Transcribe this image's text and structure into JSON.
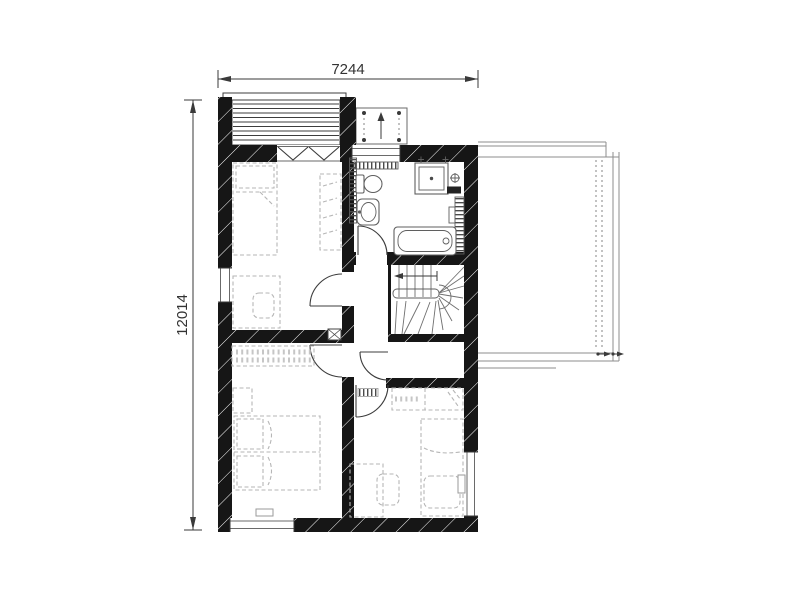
{
  "drawing": {
    "dimensions": {
      "width": "7244",
      "height": "12014"
    },
    "colors": {
      "wall": "#161616",
      "line": "#3c3c3c",
      "furniture": "#b6b6b6",
      "fixture": "#5f5f5f",
      "stair": "#6f6f6f",
      "terrace": "#8e8e8e",
      "dimtext": "#333333",
      "background": "#ffffff"
    },
    "legend": {
      "plan_type": "floor-plan-upper-storey",
      "features": [
        "loggia-deck",
        "canopy-posts",
        "up-arrow",
        "french-balcony-door",
        "toilet",
        "washbasin",
        "shower-cabin",
        "bathtub",
        "radiators",
        "winder-staircase",
        "stair-direction-arrow",
        "storage-room",
        "hallway-doors",
        "double-bed",
        "single-beds",
        "wardrobes",
        "desks-with-chairs",
        "roof-terrace",
        "terrace-railing",
        "windows",
        "drain-arrows"
      ]
    }
  }
}
